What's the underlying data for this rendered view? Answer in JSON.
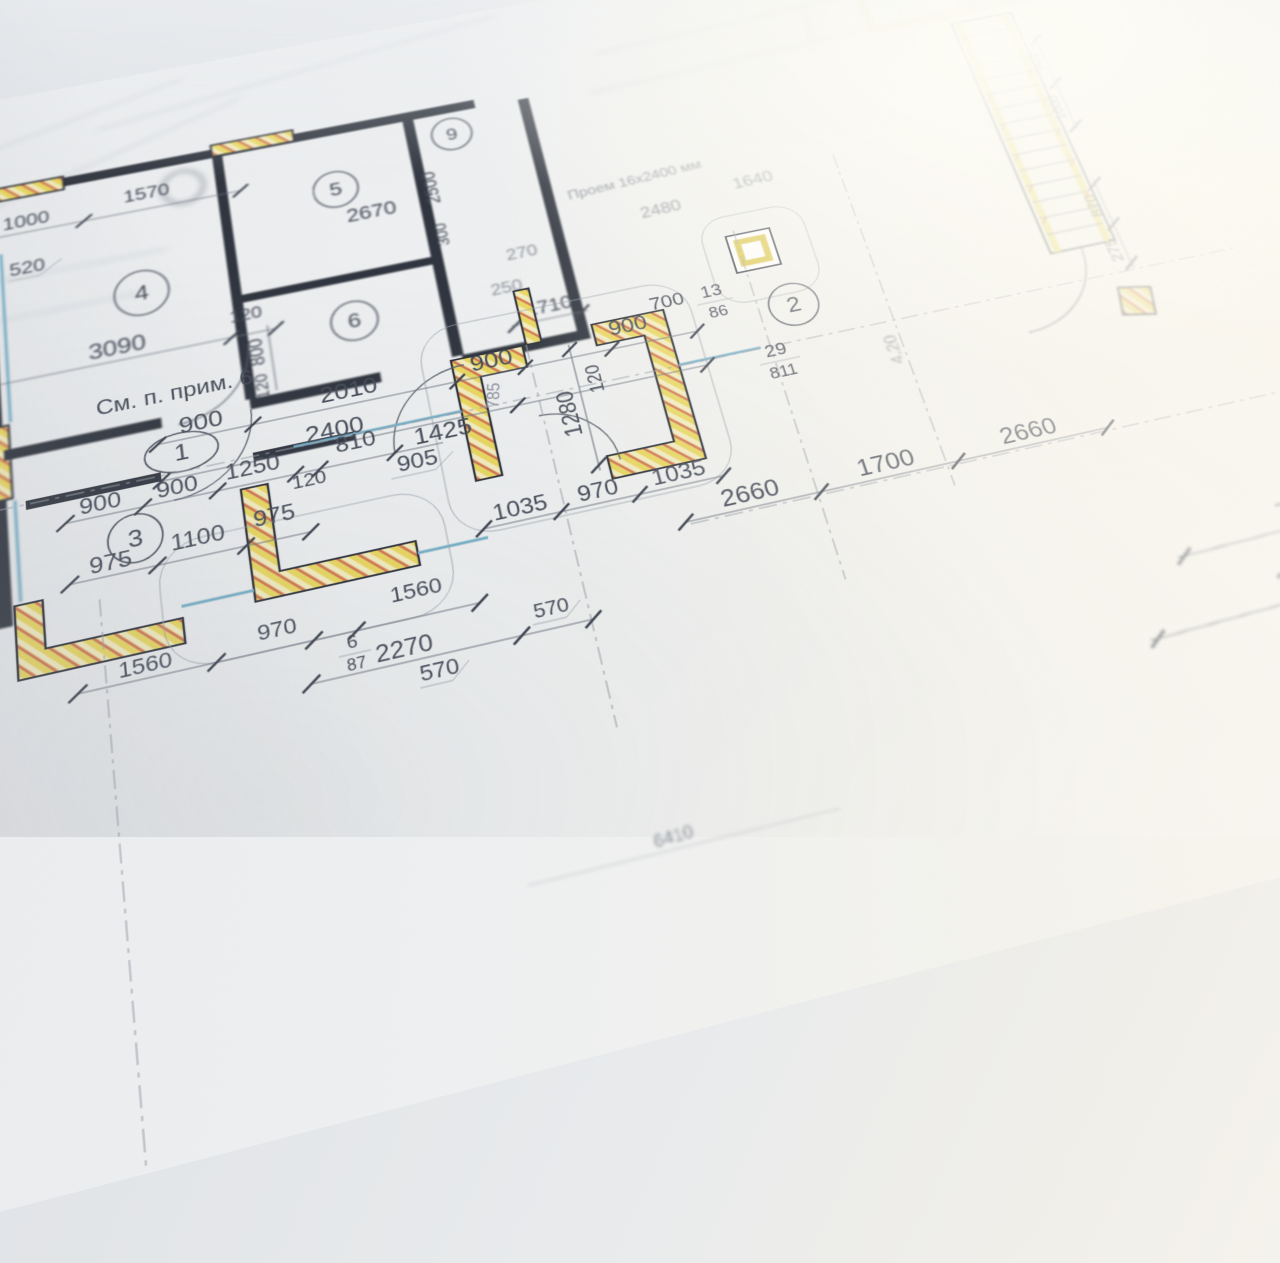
{
  "notes": {
    "see_note": "См. п. прим. 6",
    "opening": "Проем 16х2400 мм"
  },
  "rooms": {
    "r1": "1",
    "r2": "2",
    "r3": "3",
    "r4": "4",
    "r5": "5",
    "r6": "6",
    "r9": "9"
  },
  "dims": {
    "left": [
      "105",
      "3270",
      "1080",
      "3270",
      "4400",
      "1075"
    ],
    "top4": [
      "1000",
      "1570",
      "520",
      "3090",
      "120"
    ],
    "v4": [
      "800",
      "120"
    ],
    "v56": [
      "2500",
      "300",
      "2670"
    ],
    "corr1": [
      "900",
      "2010",
      "900",
      "900",
      "700"
    ],
    "corr2": [
      "2400",
      "1425"
    ],
    "r3top": [
      "900",
      "900",
      "1250",
      "120",
      "810",
      "905"
    ],
    "r3in": [
      "975",
      "1100",
      "975"
    ],
    "bottom": [
      "1560",
      "970",
      "1560",
      "2270",
      "570",
      "570",
      "6410"
    ],
    "vest": [
      "1280",
      "120",
      "785"
    ],
    "vestb": [
      "1035",
      "970",
      "1035"
    ],
    "right": [
      "2660",
      "1700",
      "2660"
    ],
    "mid": [
      "270",
      "250",
      "1710",
      "2480",
      "1640"
    ],
    "rrot": [
      "900",
      "1000",
      "870",
      "275",
      "4.20"
    ],
    "far": [
      "7560",
      "25760"
    ]
  },
  "fractions": [
    {
      "num": "29",
      "den": "811"
    },
    {
      "num": "13",
      "den": "86"
    },
    {
      "num": "6",
      "den": "87"
    }
  ],
  "colors": {
    "paper": "#eef0f1",
    "ink": "#2e3440",
    "dimension": "#6e7480",
    "insulation_yellow": "#e9d75f",
    "hatch_red": "#cf6a55",
    "window_blue": "#74aec6",
    "axis_gray": "#9aa0a8"
  }
}
